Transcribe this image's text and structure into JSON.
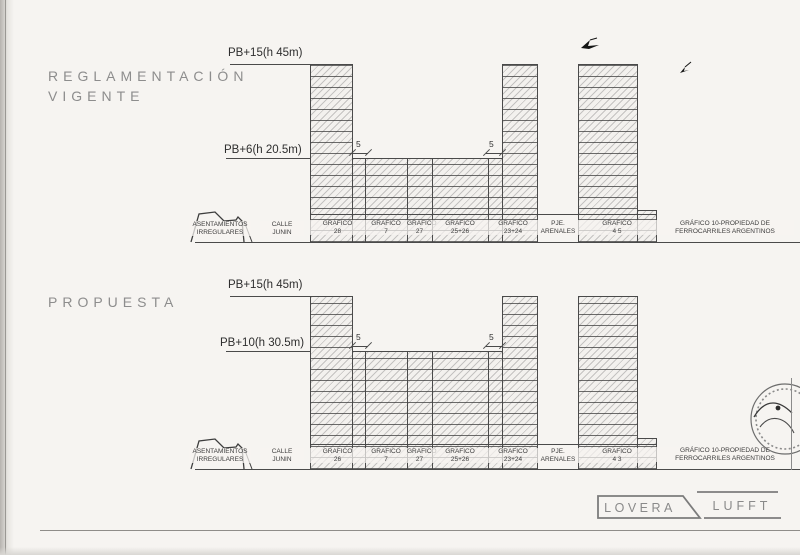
{
  "colors": {
    "paper": "#f6f4f1",
    "line": "#4a4a4a",
    "title_gray": "#8d8d8d",
    "ink": "#2e2e2e"
  },
  "sections": [
    {
      "title_line1": "REGLAMENTACIÓN",
      "title_line2": "VIGENTE",
      "upper_height_label": "PB+15(h 45m)",
      "lower_height_label": "PB+6(h 20.5m)",
      "setback_left": "5",
      "setback_right": "5",
      "hill_label_line1": "ASENTAMIENTOS",
      "hill_label_line2": "IRREGULARES",
      "street_line1": "CALLE",
      "street_line2": "JUNIN",
      "parcels": [
        {
          "line1": "GRAFICO",
          "line2": "28"
        },
        {
          "line1": "GRAFICO",
          "line2": "7"
        },
        {
          "line1": "GRAFICO",
          "line2": "27"
        },
        {
          "line1": "GRAFICO",
          "line2": "25+26"
        },
        {
          "line1": "GRAFICO",
          "line2": "23+24"
        },
        {
          "line1": "PJE.",
          "line2": "ARENALES"
        },
        {
          "line1": "GRAFICO",
          "line2": "4 5"
        }
      ],
      "railway_note_line1": "GRÁFICO 10-PROPIEDAD DE",
      "railway_note_line2": "FERROCARRILES ARGENTINOS"
    },
    {
      "title_line1": "PROPUESTA",
      "title_line2": "",
      "upper_height_label": "PB+15(h 45m)",
      "lower_height_label": "PB+10(h 30.5m)",
      "setback_left": "5",
      "setback_right": "5",
      "hill_label_line1": "ASENTAMIENTOS",
      "hill_label_line2": "IRREGULARES",
      "street_line1": "CALLE",
      "street_line2": "JUNIN",
      "parcels": [
        {
          "line1": "GRAFICO",
          "line2": "26"
        },
        {
          "line1": "GRAFICO",
          "line2": "7"
        },
        {
          "line1": "GRAFICO",
          "line2": "27"
        },
        {
          "line1": "GRAFICO",
          "line2": "25+26"
        },
        {
          "line1": "GRAFICO",
          "line2": "23+24"
        },
        {
          "line1": "PJE.",
          "line2": "ARENALES"
        },
        {
          "line1": "GRAFICO",
          "line2": "4 3"
        }
      ],
      "railway_note_line1": "GRÁFICO 10-PROPIEDAD DE",
      "railway_note_line2": "FERROCARRILES ARGENTINOS"
    }
  ],
  "logo": {
    "left": "LOVERA",
    "right": "LUFFT"
  },
  "icons": {
    "birds": "bird-ink-mark",
    "stamp": "circular-stamp-with-signature",
    "hill": "irregular-settlements-profile"
  }
}
